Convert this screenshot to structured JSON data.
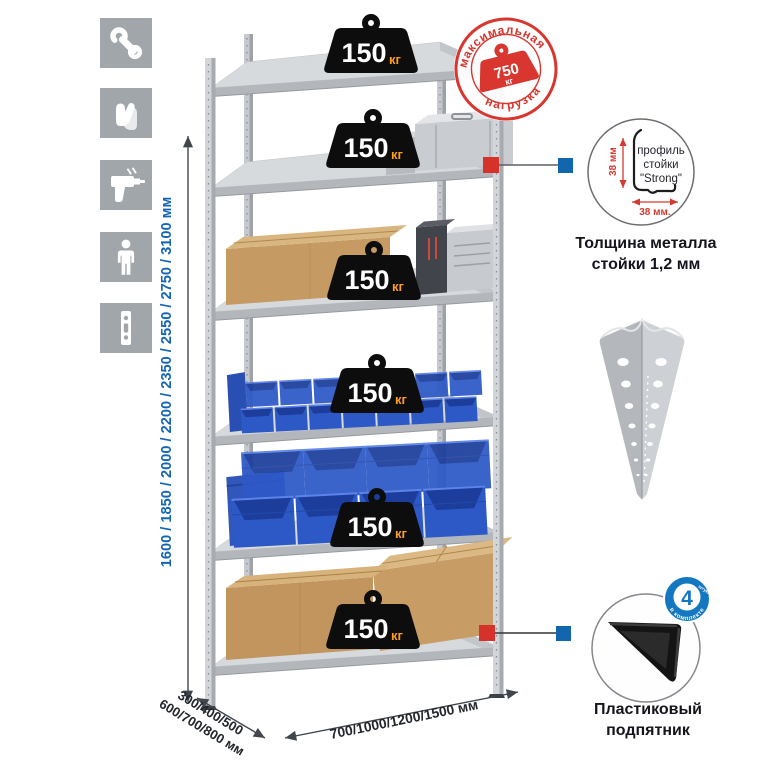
{
  "left_icons": [
    {
      "name": "wrench-icon"
    },
    {
      "name": "gloves-icon"
    },
    {
      "name": "drill-icon"
    },
    {
      "name": "person-icon"
    },
    {
      "name": "rail-icon"
    }
  ],
  "shelves": [
    {
      "load": "150",
      "unit": "кг"
    },
    {
      "load": "150",
      "unit": "кг"
    },
    {
      "load": "150",
      "unit": "кг"
    },
    {
      "load": "150",
      "unit": "кг"
    },
    {
      "load": "150",
      "unit": "кг"
    },
    {
      "load": "150",
      "unit": "кг"
    }
  ],
  "stamp": {
    "arc_top": "максимальная",
    "arc_bottom": "нагрузка",
    "value": "750",
    "unit": "кг"
  },
  "dimensions": {
    "height": "1600 / 1850 / 2000 / 2200 / 2350 / 2550 / 2750 / 3100 мм",
    "depth_line1": "300/400/500",
    "depth_line2": "600/700/800 мм",
    "width": "700/1000/1200/1500 мм"
  },
  "profile_detail": {
    "line1": "профиль",
    "line2": "стойки",
    "line3": "\"Strong\"",
    "dim_vertical": "38 мм",
    "dim_horizontal": "38 мм.",
    "caption_line1": "Толщина металла",
    "caption_line2": "стойки 1,2 мм"
  },
  "foot_detail": {
    "badge_value": "4",
    "badge_small": "штуки",
    "badge_arc": "в комплекте",
    "caption_line1": "Пластиковый",
    "caption_line2": "подпятник"
  },
  "colors": {
    "accent_red": "#d8362e",
    "accent_blue": "#1565b5",
    "connector_red": "#d7312b",
    "connector_blue": "#1166ad",
    "bin_blue": "#2d59c6",
    "icon_gray": "#a1a6aa",
    "metal_light": "#d2d5d9"
  }
}
